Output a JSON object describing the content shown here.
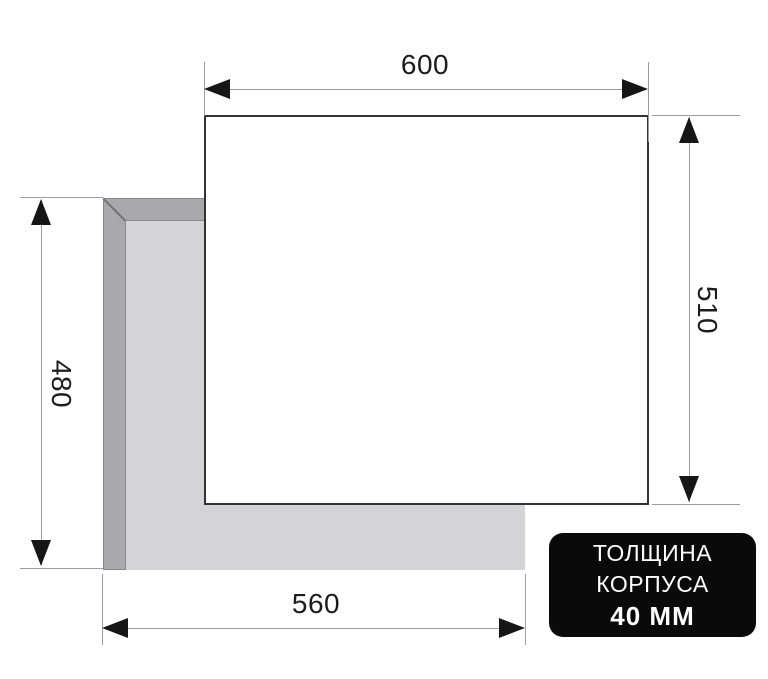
{
  "dimensions": {
    "top_width": "600",
    "right_height": "510",
    "left_height": "480",
    "bottom_width": "560"
  },
  "badge": {
    "line1": "ТОЛЩИНА",
    "line2": "КОРПУСА",
    "line3": "40 ММ"
  },
  "colors": {
    "badge_bg": "#0a0a0a",
    "badge_text": "#ffffff",
    "panel_fill": "#ffffff",
    "panel_border": "#333333",
    "cutout_bevel": "#a9a9ac",
    "cutout_fill": "#d4d4d6",
    "dimension_line": "#9d9d9d",
    "arrowhead": "#161616",
    "dimension_text": "#1c1c1c"
  }
}
